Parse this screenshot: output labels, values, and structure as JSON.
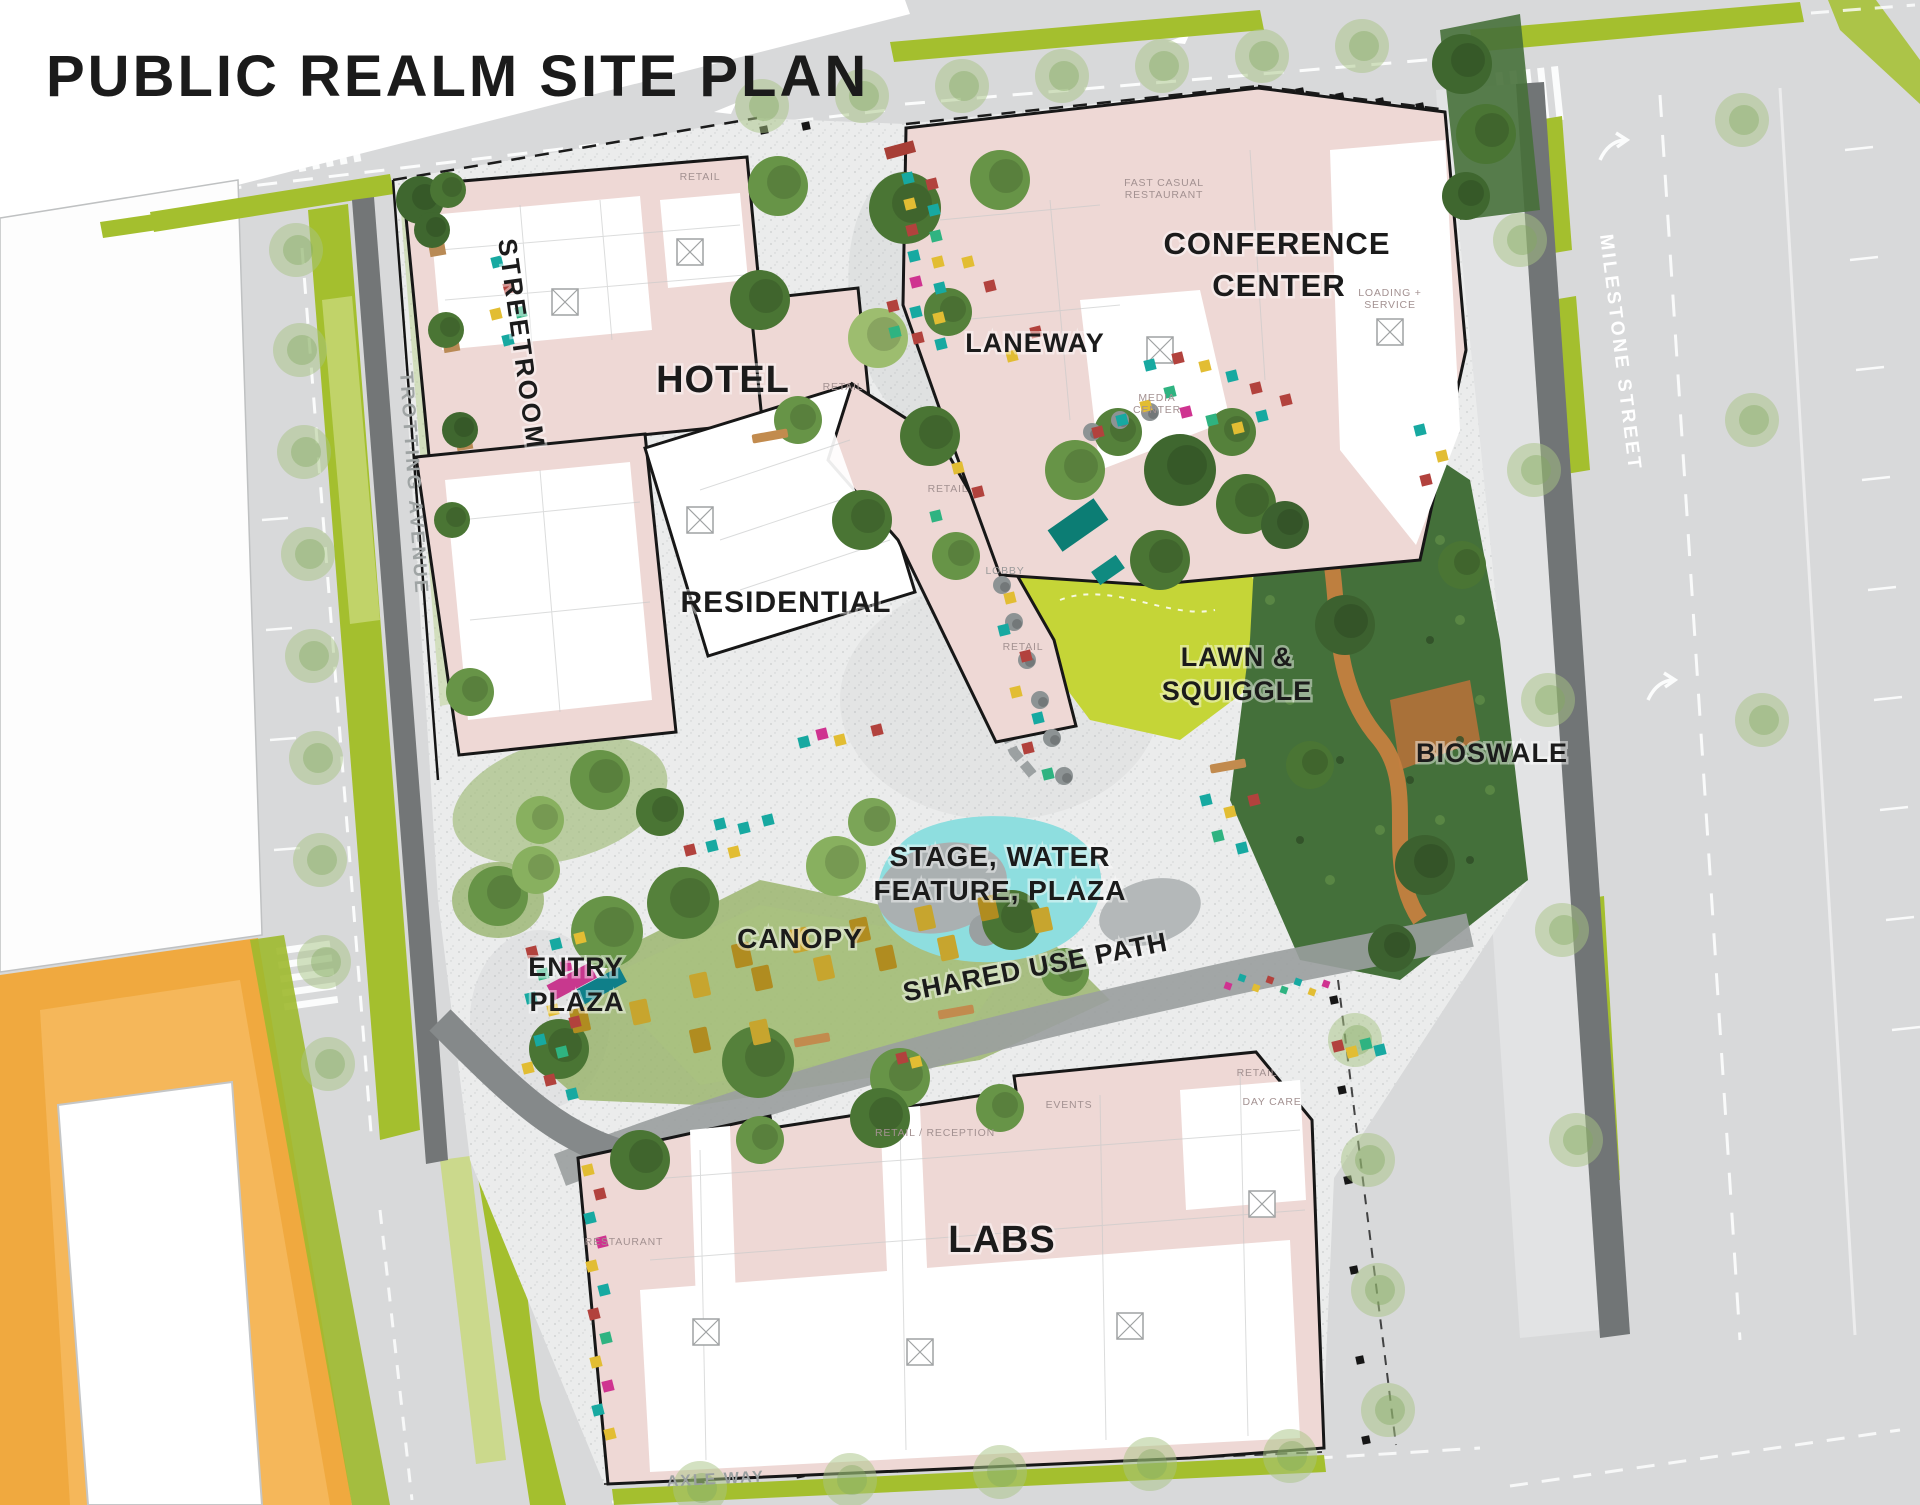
{
  "title": "PUBLIC REALM SITE PLAN",
  "areas": {
    "streetroom": "STREETROOM",
    "hotel": "HOTEL",
    "residential": "RESIDENTIAL",
    "laneway": "LANEWAY",
    "conference_line1": "CONFERENCE",
    "conference_line2": "CENTER",
    "lawn_line1": "LAWN &",
    "lawn_line2": "SQUIGGLE",
    "bioswale": "BIOSWALE",
    "stage_line1": "STAGE, WATER",
    "stage_line2": "FEATURE, PLAZA",
    "canopy": "CANOPY",
    "entry_line1": "ENTRY",
    "entry_line2": "PLAZA",
    "shared_use_path": "SHARED USE PATH",
    "labs": "LABS"
  },
  "streets": {
    "trotting": "TROTTING AVENUE",
    "milestone": "MILESTONE STREET",
    "axle": "AXLE WAY"
  },
  "building_labels": {
    "fast_casual_line1": "FAST CASUAL",
    "fast_casual_line2": "RESTAURANT",
    "media_line1": "MEDIA",
    "media_line2": "CENTER",
    "loading_line1": "LOADING +",
    "loading_line2": "SERVICE",
    "retail": "RETAIL",
    "lobby": "LOBBY",
    "retail_reception": "RETAIL / RECEPTION",
    "events": "EVENTS",
    "day_care": "DAY CARE",
    "restaurant": "RESTAURANT"
  },
  "palette": {
    "building_pink": "#eed8d5",
    "outline_black": "#171717",
    "site_paver_gray": "#ebecec",
    "street_gray": "#d8d9da",
    "verge_green": "#a4bf2e",
    "lawn_green": "#c5d537",
    "tree_green_dark": "#4a7534",
    "tree_green_mid": "#679447",
    "tree_green_light": "#88b05f",
    "bioswale_green": "#44703a",
    "water_teal": "#8ededf",
    "orange_block": "#f0a93f",
    "trail_orange": "#c5803f",
    "furniture_teal": "#17a9a1",
    "furniture_red": "#b2423d",
    "furniture_yellow": "#e2bd33",
    "furniture_magenta": "#cf3390",
    "furniture_green": "#2fb381"
  }
}
